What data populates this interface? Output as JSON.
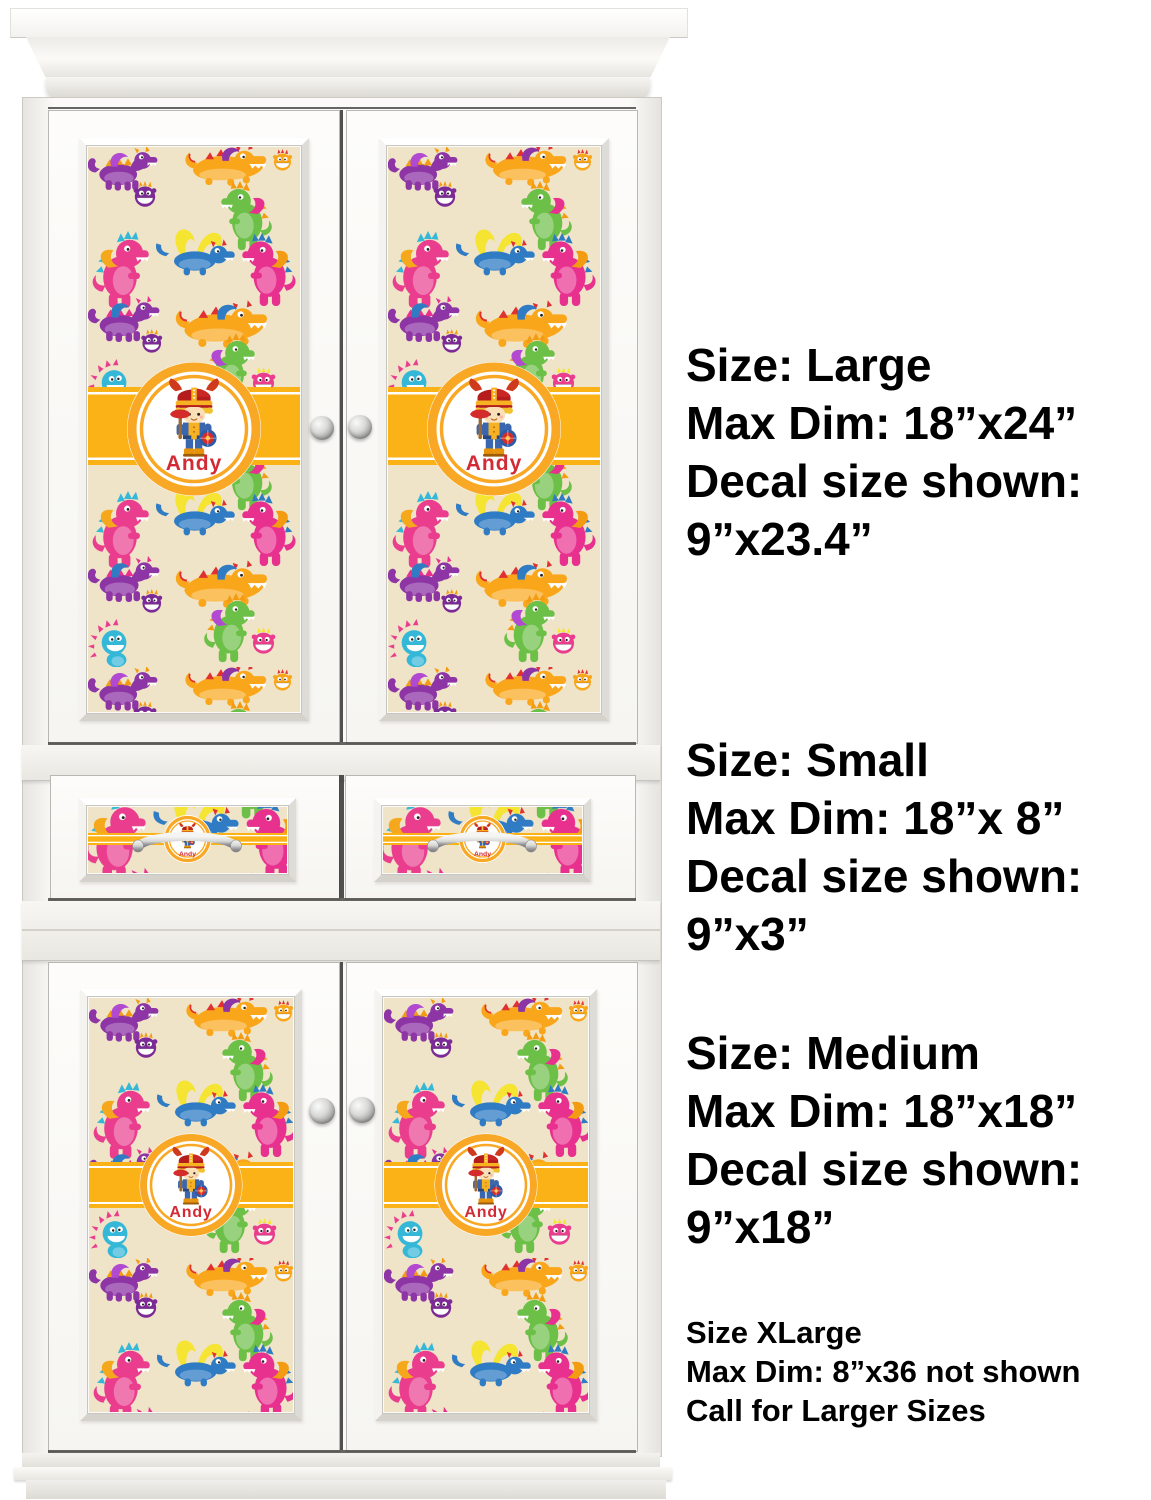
{
  "product": {
    "badge_name": "Andy",
    "pattern_name": "colorful-dragons",
    "colors": {
      "decal_background": "#efe4c8",
      "ribbon_yellow": "#fbb217",
      "badge_ring_orange": "#f9a825",
      "name_red": "#d22b35",
      "cabinet_white": "#fbfaf8"
    }
  },
  "size_labels": {
    "large": {
      "l1": "Size: Large",
      "l2": "Max Dim: 18”x24”",
      "l3": "Decal size shown:",
      "l4": "9”x23.4”"
    },
    "small": {
      "l1": "Size: Small",
      "l2": "Max Dim: 18”x 8”",
      "l3": "Decal size shown:",
      "l4": "9”x3”"
    },
    "medium": {
      "l1": "Size: Medium",
      "l2": "Max Dim: 18”x18”",
      "l3": "Decal size shown:",
      "l4": "9”x18”"
    },
    "xlarge": {
      "l1": "Size XLarge",
      "l2": "Max Dim: 8”x36 not shown",
      "l3": "Call for Larger Sizes"
    }
  },
  "icons": {
    "knob": "cabinet-knob",
    "handle": "drawer-pull-handle",
    "badge": "viking-boy-badge"
  }
}
